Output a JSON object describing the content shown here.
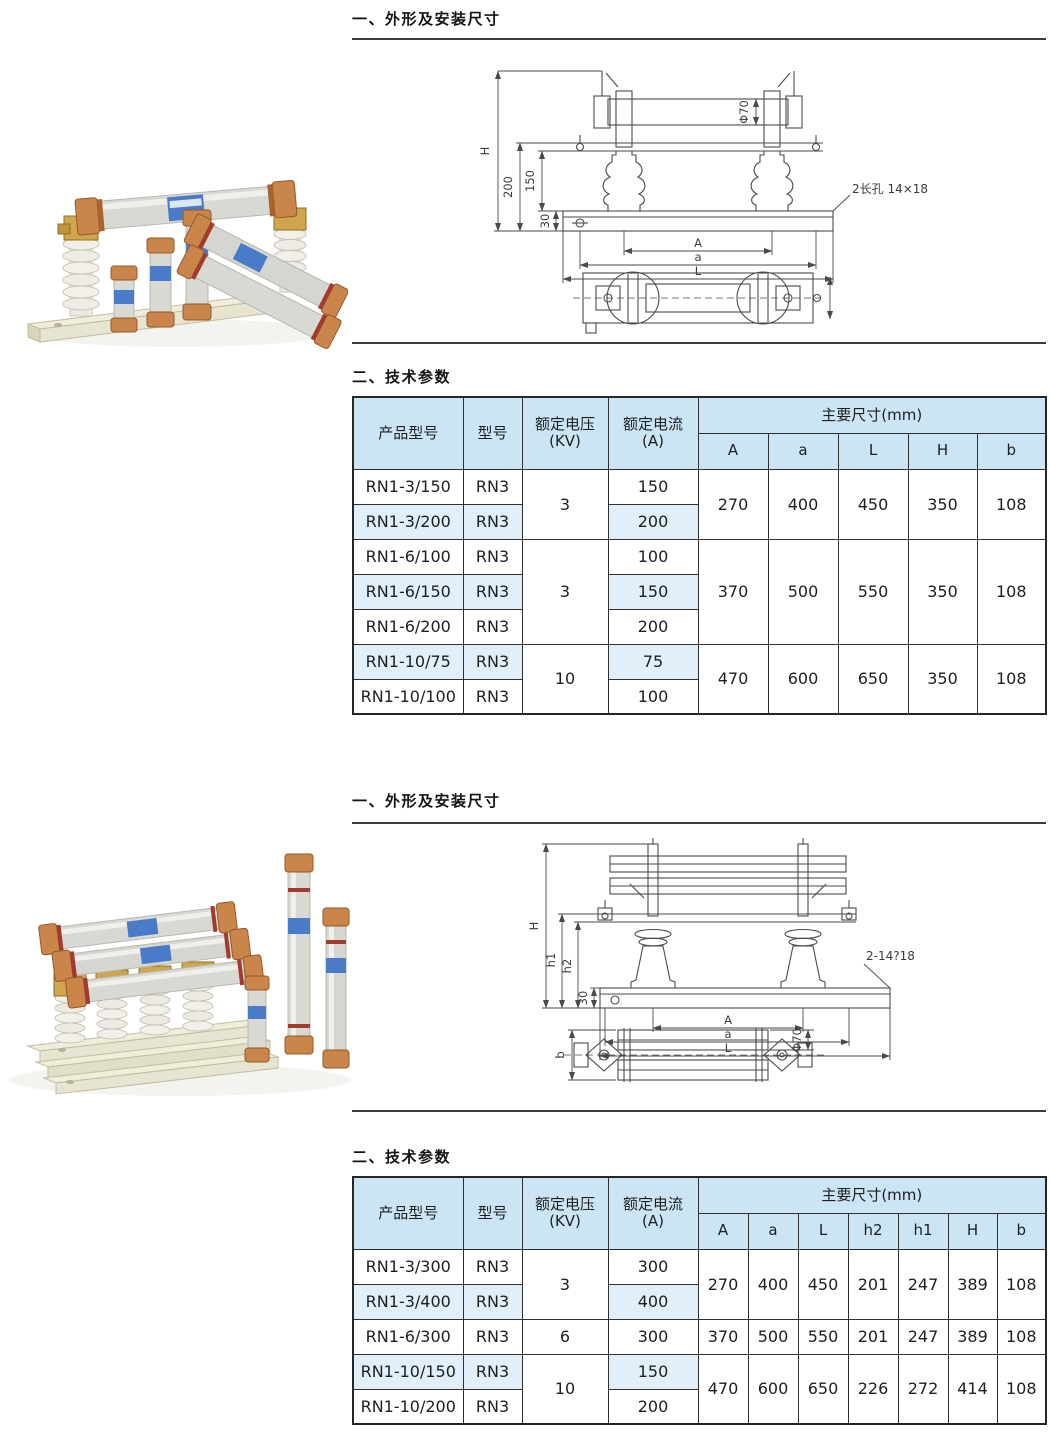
{
  "colors": {
    "header_blue": "#cbe5f5",
    "row_highlight_blue": "#e0eff9",
    "table_border": "#2e2e2e",
    "drawing_line": "#4a4a4a",
    "photo_rail": "#e7e4d2",
    "photo_copper": "#c9854a",
    "photo_tube": "#d9d9d4",
    "photo_label_blue": "#4a7bc8"
  },
  "section_outline_1": {
    "title": "一、外形及安装尺寸"
  },
  "section_params_1": {
    "title": "二、技术参数"
  },
  "section_outline_2": {
    "title": "一、外形及安装尺寸"
  },
  "section_params_2": {
    "title": "二、技术参数"
  },
  "drawing1": {
    "dim_H": "H",
    "dim_200": "200",
    "dim_150": "150",
    "dim_30": "30",
    "dim_A": "A",
    "dim_a": "a",
    "dim_L": "L",
    "dim_phi70": "Φ70",
    "note": "2长孔 14×18"
  },
  "drawing2": {
    "dim_H": "H",
    "dim_h1": "h1",
    "dim_h2": "h2",
    "dim_30": "30",
    "dim_A": "A",
    "dim_a": "a",
    "dim_L": "L",
    "dim_b": "b",
    "dim_phi70": "Φ70",
    "note": "2-14?18"
  },
  "table1": {
    "headers": {
      "product": "产品型号",
      "model": "型号",
      "voltage_line1": "额定电压",
      "voltage_line2": "(KV)",
      "current_line1": "额定电流",
      "current_line2": "(A)",
      "dims_group": "主要尺寸(mm)",
      "dims": [
        "A",
        "a",
        "L",
        "H",
        "b"
      ]
    },
    "rows": [
      {
        "product": "RN1-3/150",
        "model": "RN3",
        "voltage": "3",
        "current": "150",
        "A": "270",
        "a": "400",
        "L": "450",
        "H": "350",
        "b": "108"
      },
      {
        "product": "RN1-3/200",
        "model": "RN3",
        "current": "200"
      },
      {
        "product": "RN1-6/100",
        "model": "RN3",
        "voltage": "3",
        "current": "100",
        "A": "370",
        "a": "500",
        "L": "550",
        "H": "350",
        "b": "108"
      },
      {
        "product": "RN1-6/150",
        "model": "RN3",
        "current": "150"
      },
      {
        "product": "RN1-6/200",
        "model": "RN3",
        "current": "200"
      },
      {
        "product": "RN1-10/75",
        "model": "RN3",
        "voltage": "10",
        "current": "75",
        "A": "470",
        "a": "600",
        "L": "650",
        "H": "350",
        "b": "108"
      },
      {
        "product": "RN1-10/100",
        "model": "RN3",
        "current": "100"
      }
    ]
  },
  "table2": {
    "headers": {
      "product": "产品型号",
      "model": "型号",
      "voltage_line1": "额定电压",
      "voltage_line2": "(KV)",
      "current_line1": "额定电流",
      "current_line2": "(A)",
      "dims_group": "主要尺寸(mm)",
      "dims": [
        "A",
        "a",
        "L",
        "h2",
        "h1",
        "H",
        "b"
      ]
    },
    "rows": [
      {
        "product": "RN1-3/300",
        "model": "RN3",
        "voltage": "3",
        "current": "300",
        "A": "270",
        "a": "400",
        "L": "450",
        "h2": "201",
        "h1": "247",
        "H": "389",
        "b": "108"
      },
      {
        "product": "RN1-3/400",
        "model": "RN3",
        "current": "400"
      },
      {
        "product": "RN1-6/300",
        "model": "RN3",
        "voltage": "6",
        "current": "300",
        "A": "370",
        "a": "500",
        "L": "550",
        "h2": "201",
        "h1": "247",
        "H": "389",
        "b": "108"
      },
      {
        "product": "RN1-10/150",
        "model": "RN3",
        "voltage": "10",
        "current": "150",
        "A": "470",
        "a": "600",
        "L": "650",
        "h2": "226",
        "h1": "272",
        "H": "414",
        "b": "108"
      },
      {
        "product": "RN1-10/200",
        "model": "RN3",
        "current": "200"
      }
    ]
  }
}
